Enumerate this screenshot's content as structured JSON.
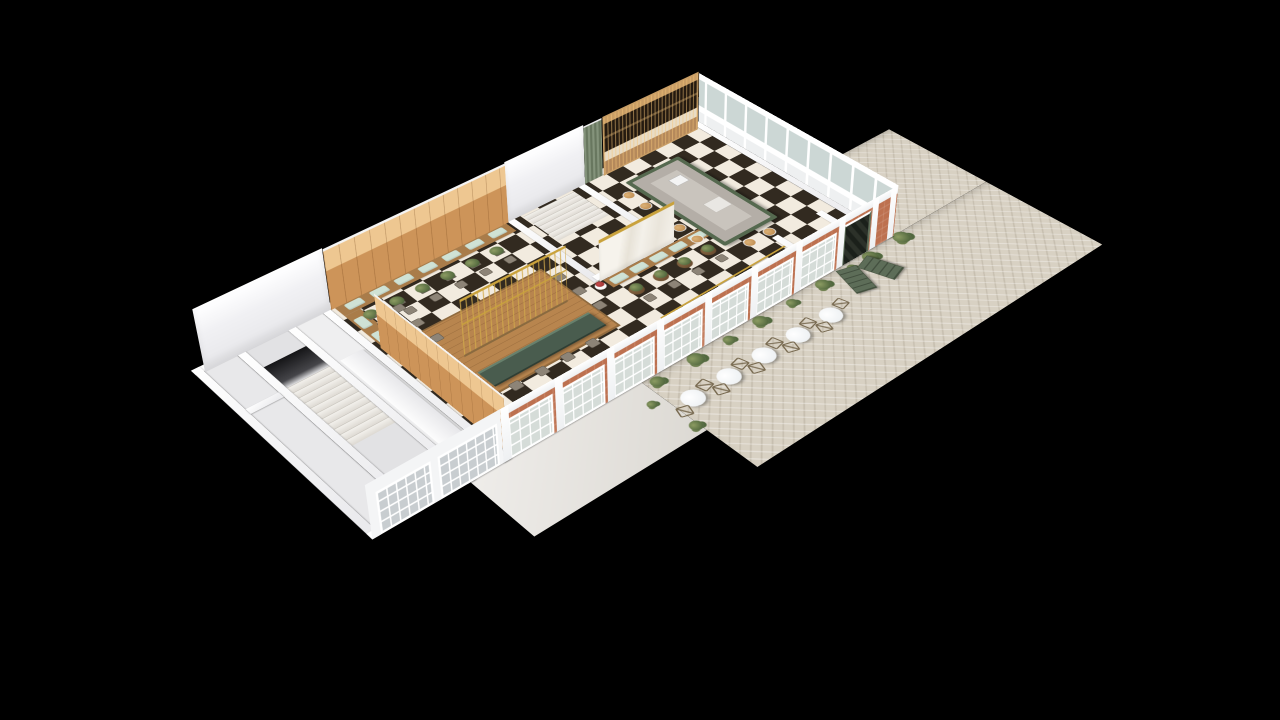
{
  "scene": {
    "type": "isometric-3d-floorplan-render",
    "subject": "restaurant and bar floor plan with outdoor patio",
    "background": "#000000",
    "rooms": [
      {
        "name": "stairwell-block"
      },
      {
        "name": "service-corridor"
      },
      {
        "name": "dining-room"
      },
      {
        "name": "stair-vestibule"
      },
      {
        "name": "bar-room"
      },
      {
        "name": "entry-vestibule"
      },
      {
        "name": "patio"
      }
    ]
  },
  "palette": {
    "background": "#000000",
    "wall_white": "#f1f1f4",
    "checker_dark": "#322a20",
    "checker_light": "#f2ebdf",
    "wood_panel": "#cd9459",
    "wood_panel_upper": "#eec791",
    "wood_floor": "#b8854e",
    "brass": "#c9a23c",
    "green_marble": "#55694f",
    "counter_green": "#495c4e",
    "bar_top_gray": "#b4aea7",
    "mint_cushion": "#cfe2d5",
    "brick": "#bd7150",
    "door_green": "#5d6d58",
    "curtain_green": "#76856d",
    "paver": "#d8d1c3",
    "patio_table_white": "#f4f6f8",
    "plant_green": "#5d7245",
    "flower_red": "#a83232"
  },
  "layout": {
    "plane": {
      "w": 1200,
      "h": 660
    },
    "ground": {
      "patioMain": {
        "x": 470,
        "y": 440,
        "w": 670,
        "h": 208
      },
      "patioWing": {
        "x": 940,
        "y": 250,
        "w": 200,
        "h": 190
      },
      "walkway": {
        "x": 200,
        "y": 440,
        "w": 270,
        "h": 120
      }
    },
    "floors": {
      "checker": {
        "x": 262,
        "y": 52,
        "w": 666,
        "h": 376
      },
      "leftStrips": [
        {
          "x": 72,
          "y": 52,
          "w": 48,
          "h": 376,
          "cls": "floorA"
        },
        {
          "x": 132,
          "y": 52,
          "w": 64,
          "h": 376,
          "cls": "floorB"
        },
        {
          "x": 208,
          "y": 52,
          "w": 42,
          "h": 376,
          "cls": "floorC"
        }
      ]
    },
    "leftStairs": {
      "x": 132,
      "y": 150,
      "w": 64,
      "treads": 11,
      "treadH": 13,
      "voidY": 96,
      "voidH": 54
    },
    "corridorCounter": {
      "x": 212,
      "y": 150,
      "w": 34,
      "h": 230
    },
    "vestStairs": {
      "x": 584,
      "y": 58,
      "w": 94,
      "treads": 7,
      "treadH": 11
    },
    "platform": {
      "x": 320,
      "y": 170,
      "w": 200,
      "h": 160
    },
    "counter": {
      "x": 328,
      "y": 286,
      "w": 184,
      "h": 30
    },
    "platformChairsFront": {
      "y": 338,
      "xs": [
        348,
        390,
        432,
        474
      ]
    },
    "platformChairsRight": {
      "x": 532,
      "ys": [
        200,
        242,
        284
      ]
    },
    "goldRail": {
      "x": 575,
      "y": 356,
      "w": 240,
      "h": 3
    },
    "booth": {
      "benchBack": {
        "x": 268,
        "y": 52,
        "w": 288,
        "h": 26
      },
      "benchLeft": {
        "x": 268,
        "y": 78,
        "w": 24,
        "h": 190
      },
      "cushionsBack": {
        "y": 57,
        "xs": [
          280,
          320,
          360,
          400,
          440,
          480,
          520
        ]
      },
      "cushionsLeft": {
        "x": 271,
        "ys": [
          92,
          132,
          172,
          212
        ]
      },
      "tablesBack": {
        "y": 100,
        "xs": [
          296,
          338,
          380,
          422,
          464,
          506
        ]
      },
      "chairsBack": {
        "y": 124,
        "xs": [
          296,
          338,
          380,
          422,
          464,
          506
        ]
      },
      "tablesLeft": {
        "x": 306,
        "ys": [
          110,
          152,
          194
        ]
      },
      "chairsLeft": {
        "x": 330,
        "ys": [
          110,
          152,
          194
        ]
      }
    },
    "frontTables": [
      [
        310,
        390
      ],
      [
        362,
        402
      ]
    ],
    "banquette": {
      "bench": {
        "x": 572,
        "y": 246,
        "w": 186,
        "h": 22
      },
      "cushions": {
        "y": 250,
        "xs": [
          578,
          614,
          650,
          686,
          722
        ]
      },
      "tables": {
        "y": 292,
        "xs": [
          592,
          636,
          680,
          724
        ]
      },
      "chairs": {
        "y": 316,
        "xs": [
          592,
          636,
          680,
          724
        ]
      },
      "pedestal": {
        "x": 561,
        "y": 254
      }
    },
    "bar": {
      "island": {
        "x": 748,
        "y": 90,
        "w": 104,
        "h": 210
      },
      "sink": {
        "x": 798,
        "y": 128,
        "w": 22,
        "h": 18
      },
      "prep": {
        "x": 794,
        "y": 206,
        "w": 30,
        "h": 26
      },
      "stoolsLeft": {
        "x": 731,
        "ys": [
          118,
          154,
          190,
          226,
          262
        ]
      },
      "stoolsFront": {
        "y": 317,
        "xs": [
          780,
          818
        ]
      }
    },
    "wallBands": [
      [
        60,
        40,
        880,
        12
      ],
      [
        60,
        40,
        12,
        400
      ],
      [
        928,
        40,
        12,
        400
      ],
      [
        60,
        428,
        880,
        12
      ],
      [
        250,
        52,
        12,
        388
      ],
      [
        560,
        52,
        12,
        190
      ],
      [
        690,
        52,
        12,
        190
      ],
      [
        566,
        230,
        136,
        12
      ],
      [
        120,
        52,
        12,
        388
      ],
      [
        196,
        52,
        12,
        388
      ],
      [
        72,
        150,
        48,
        12
      ],
      [
        810,
        330,
        12,
        98
      ],
      [
        898,
        330,
        12,
        98
      ]
    ],
    "standingWalls": [
      {
        "name": "back-wall-left",
        "cls": "sw-white",
        "x": 72,
        "y": -22,
        "w": 190,
        "h": 74
      },
      {
        "name": "dining-wood-wall",
        "cls": "sw-wood",
        "x": 262,
        "y": -20,
        "w": 298,
        "h": 72
      },
      {
        "name": "vestibule-back-wall",
        "cls": "sw-white",
        "x": 560,
        "y": -22,
        "w": 142,
        "h": 74
      },
      {
        "name": "bar-curtain",
        "cls": "sw-curtain",
        "x": 702,
        "y": -20,
        "w": 34,
        "h": 72
      },
      {
        "name": "back-bar-shelving",
        "cls": "sw-backbar",
        "x": 736,
        "y": -20,
        "w": 184,
        "h": 72
      },
      {
        "name": "marble-partition",
        "cls": "sw-marble",
        "x": 566,
        "y": 194,
        "w": 136,
        "h": 48
      },
      {
        "name": "brass-wine-rack",
        "cls": "sw-lattice",
        "x": 334,
        "y": 181,
        "w": 172,
        "h": 64
      },
      {
        "name": "storefront-facade",
        "cls": "sw-facade",
        "x": 250,
        "y": 376,
        "w": 690,
        "h": 64
      },
      {
        "name": "left-block-facade",
        "cls": "sw-glasswall",
        "x": 60,
        "y": 376,
        "w": 190,
        "h": 64
      },
      {
        "name": "dining-left-wall",
        "cls": "swr-wood",
        "x": 198,
        "y": 164,
        "w": 64,
        "h": 264
      },
      {
        "name": "right-end-wall",
        "cls": "swr-glass",
        "x": 876,
        "y": 40,
        "w": 64,
        "h": 400
      }
    ],
    "facade": {
      "fasciaH": 10,
      "pilasters": [
        0,
        82,
        164,
        246,
        328,
        410,
        492,
        574,
        640,
        676
      ],
      "pilasterW": 12,
      "windows": {
        "xs": [
          10,
          92,
          174,
          256,
          338,
          420,
          502
        ],
        "w": 62,
        "top": 16,
        "h": 42
      },
      "door": {
        "x": 584,
        "w": 46,
        "top": 13,
        "h": 51
      }
    },
    "leftFacadeWindows": [
      {
        "x": 12,
        "w": 70,
        "top": 14,
        "h": 44
      },
      {
        "x": 98,
        "w": 80,
        "top": 14,
        "h": 44
      }
    ],
    "patioTables": [
      [
        498,
        505
      ],
      [
        560,
        505
      ],
      [
        622,
        505
      ],
      [
        684,
        505
      ],
      [
        746,
        505
      ],
      [
        972,
        368
      ]
    ],
    "patioChairOffsets": [
      [
        -27,
        9,
        18
      ],
      [
        25,
        -11,
        -14
      ]
    ],
    "patioPlants": [
      [
        486,
        452,
        20
      ],
      [
        552,
        452,
        24
      ],
      [
        610,
        452,
        17
      ],
      [
        668,
        452,
        22
      ],
      [
        726,
        452,
        17
      ],
      [
        786,
        452,
        22
      ],
      [
        842,
        452,
        15
      ],
      [
        880,
        452,
        24
      ],
      [
        946,
        450,
        26
      ],
      [
        952,
        300,
        22
      ],
      [
        466,
        545,
        18
      ],
      [
        452,
        480,
        14
      ],
      [
        930,
        420,
        16
      ]
    ],
    "pot": {
      "x": 952,
      "y": 312,
      "r": 9
    },
    "doors": [
      [
        812,
        446,
        16
      ],
      [
        856,
        450,
        -18
      ]
    ]
  }
}
